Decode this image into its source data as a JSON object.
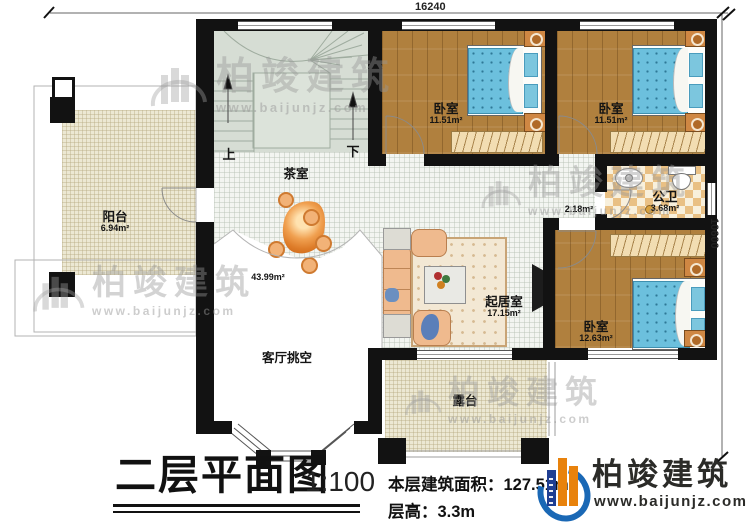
{
  "dimensions": {
    "top": "16240",
    "right": "10600"
  },
  "stairs": {
    "up": "上",
    "down": "下"
  },
  "rooms": {
    "balcony": {
      "name": "阳台",
      "area": "6.94m²"
    },
    "tea_room": {
      "name": "茶室"
    },
    "hall": {
      "area": "43.99m²"
    },
    "bedroom1": {
      "name": "卧室",
      "area": "11.51m²"
    },
    "bedroom2": {
      "name": "卧室",
      "area": "11.51m²"
    },
    "bathroom": {
      "name": "公卫",
      "area": "3.68m²"
    },
    "corridor": {
      "area": "2.18m²"
    },
    "bedroom3": {
      "name": "卧室",
      "area": "12.63m²"
    },
    "living_room": {
      "name": "起居室",
      "area": "17.15m²"
    },
    "void": {
      "name": "客厅挑空"
    },
    "terrace": {
      "name": "露台"
    }
  },
  "title_block": {
    "title": "二层平面图",
    "scale": "1:100",
    "floor_area_label": "本层建筑面积：127.51m²",
    "floor_height_label": "层高：3.3m"
  },
  "logo": {
    "name": "柏竣建筑",
    "url": "www.baijunjz.com"
  },
  "watermark": {
    "text": "柏竣建筑",
    "url": "www.baijunjz.com"
  },
  "colors": {
    "wall": "#121212",
    "wood_floor": "#b0803e",
    "bed_blue": "#6cc0dd",
    "tile_light": "#f3f5f1",
    "tile_beige": "#ece8d3",
    "stair": "#d6ddd4",
    "bath_checker": "#e9c084",
    "logo_blue": "#1a68b5",
    "logo_orange": "#e8820c",
    "decor_orange": "#e0832f"
  }
}
